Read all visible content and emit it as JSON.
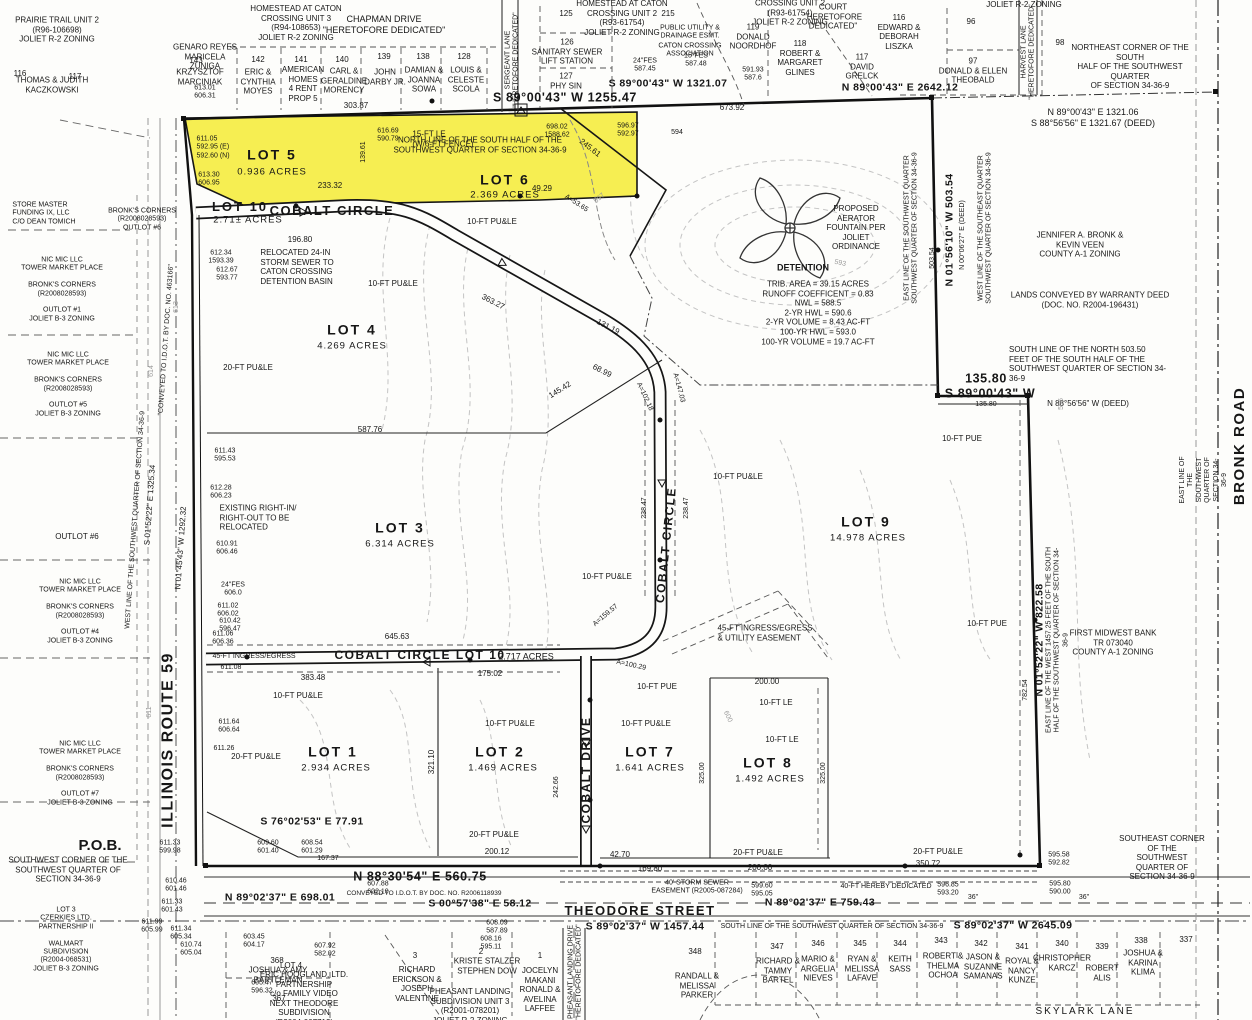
{
  "colors": {
    "highlight": "#f6ee52",
    "ink": "#161616",
    "contour": "#9a9a9a",
    "paper": "#fdfdfb"
  },
  "L": {
    "prairie": "PRAIRIE TRAIL UNIT 2\n(R96-106698)\nJOLIET R-2 ZONING",
    "genaro": "GENARO REYES\nMARICELA\nZUNIGA",
    "n116a": "116",
    "kaczkowski": "THOMAS & JUDITH\nKACZKOWSKI",
    "n117a": "117",
    "n143": "143",
    "marciniak": "KRZYSZTOF\nMARCINIAK",
    "el1": "613.01\n606.31",
    "n142": "142",
    "moyes": "ERIC &\nCYNTHIA\nMOYES",
    "n141": "141",
    "american": "AMERICAN\nHOMES\n4 RENT\nPROP 5",
    "n140": "140",
    "morency": "CARL &\nGERALDINE\nMORENCY",
    "n139": "139",
    "darby": "JOHN\nDARBY JR.",
    "n138": "138",
    "sowa": "DAMIAN &\nJOANNA\nSOWA",
    "n128": "128",
    "scola": "LOUIS &\nCELESTE\nSCOLA",
    "homestead3": "HOMESTEAD AT CATON\nCROSSING UNIT 3\n(R94-108653)\nJOLIET R-2 ZONING",
    "chapman": "CHAPMAN DRIVE\n\"HERETOFORE DEDICATED\"",
    "sergeant": "SERGEANT LANE\n\"HERETOFORE DEDICATED\"",
    "n125": "125",
    "sanitary": "126\nSANITARY SEWER\nLIFT STATION",
    "physin": "127\nPHY SIN",
    "homestead2": "HOMESTEAD AT CATON\nCROSSING UNIT 2\n(R93-61754)\nJOLIET R-2 ZONING",
    "n215": "215",
    "pude": "PUBLIC UTILITY &\nDRAINAGE ESMT.",
    "caton": "CATON CROSSING\nASSOCIATION",
    "fes587a": "24\"FES\n587.45",
    "fes587b": "15\"FES\n587.48",
    "dim1321": "S 89°00'43\" W 1321.07",
    "dim1255": "S 89°00'43\" W 1255.47",
    "homestead2b": "CROSSING UNIT 2\n(R93-61754)\nJOLIET R-2 ZONING",
    "court": "COURT\n\"HERETOFORE\nDEDICATED\"",
    "noordhof": "119\nDONALD\nNOORDHOF",
    "glines": "118\nROBERT &\nMARGARET\nGLINES",
    "el2": "591.93\n587.6",
    "liszka": "116\nEDWARD &\nDEBORAH\nLISZKA",
    "grelck": "117\nDAVID\nGRELCK",
    "n96": "96",
    "theobald": "97\nDONALD & ELLEN\nTHEOBALD",
    "harvest": "HARVEST LANE\n\"HERETOFORE DEDICATED\"",
    "n98": "98",
    "jolietr2": "JOLIET R-2 ZONING",
    "necorner": "NORTHEAST CORNER OF THE SOUTH\nHALF OF THE SOUTHWEST QUARTER\nOF SECTION 34-36-9",
    "dim2642": "N 89°00'43\" E 2642.12",
    "dim1321b": "N 89°00'43\" E 1321.06\nS 88°56'56\" E 1321.67 (DEED)",
    "d673": "673.92",
    "el3": "698.02\n1588.62",
    "el4": "616.69\n590.79",
    "northline": "NORTH LINE OF THE SOUTH HALF OF THE\nSOUTHWEST QUARTER OF SECTION 34-36-9",
    "d245": "245.61",
    "lot5": "LOT 5",
    "lot5a": "0.936 ACRES",
    "el5": "611.05\n592.95 (E)\n592.60 (N)",
    "el6": "613.30\n606.95",
    "le15": "15-FT LE\n(W/6-FT FENCE)",
    "d303": "303.87",
    "d233": "233.32",
    "d49": "49.29",
    "a53": "A=53.65",
    "lot10": "LOT 10",
    "lot10a": "2.71± ACRES",
    "cobaltcircle": "COBALT CIRCLE",
    "lot6": "LOT 6",
    "lot6a": "2.369 ACRES",
    "el7": "596.97\n592.97",
    "c594a": "594",
    "d139": "139.61",
    "aerator": "PROPOSED\nAERATOR\nFOUNTAIN PER\nJOLIET\nORDINANCE",
    "detention": "DETENTION",
    "detdata": "TRIB. AREA = 39.15 ACRES\nRUNOFF COEFFICENT = 0.83\nNWL = 588.5\n2-YR HWL = 590.6\n2-YR VOLUME = 8.43 AC-FT\n100-YR HWL = 593.0\n100-YR VOLUME = 19.7 AC-FT",
    "eastline1": "EAST LINE OF THE SOUTHWEST QUARTER\nSOUTHWEST QUARTER OF SECTION 34-36-9",
    "dim503": "N 01°56'10\" W 503.54",
    "dim503d": "N 00°06'27\" E (DEED)",
    "d503": "503.54",
    "westline1": "WEST LINE OF THE SOUTHEAST QUARTER\nSOUTHWEST QUARTER OF SECTION 34-36-9",
    "bronkveen": "JENNIFER A. BRONK &\nKEVIN VEEN\nCOUNTY A-1 ZONING",
    "lands": "LANDS CONVEYED BY WARRANTY DEED\n(DOC. NO. R2004-196431)",
    "southline503": "SOUTH LINE OF THE NORTH 503.50\nFEET OF THE SOUTH HALF OF THE\nSOUTHWEST QUARTER OF SECTION 34-36-9",
    "d135": "135.80",
    "dim8900": "S 89°00'43\" W",
    "d135b": "135.80",
    "dim8856": "N 88°56'56\" W (DEED)",
    "pue1": "10-FT PUE",
    "eastline2": "EAST LINE OF THE SOUTHWEST QUARTER OF SECTION 34-36-9",
    "bronkroad": "BRONK ROAD",
    "lot4": "LOT 4",
    "lot4a": "4.269 ACRES",
    "pu20a": "20-FT PU&LE",
    "relocated": "RELOCATED 24-IN\nSTORM SEWER TO\nCATON CROSSING\nDETENTION BASIN",
    "el8": "612.34\n1593.39",
    "el9": "612.67\n593.77",
    "pu10a": "10-FT PU&LE",
    "pu10b": "10-FT PU&LE",
    "d196": "196.80",
    "d587": "587.76",
    "el10": "611.43\n595.53",
    "el11": "612.28\n606.23",
    "existing": "EXISTING RIGHT-IN/\nRIGHT-OUT TO BE\nRELOCATED",
    "el12": "610.91\n606.46",
    "fes606": "24\"FES\n606.0",
    "el13": "611.02\n606.02",
    "el14": "610.42\n596.47",
    "el15": "611.06\n606.36",
    "d45a": "45-FT INGRESS/EGRESS",
    "el16": "611.08",
    "lot3": "LOT 3",
    "lot3a": "6.314 ACRES",
    "cclot10": "COBALT CIRCLE LOT 10",
    "lot10b": "2.717 ACRES",
    "d645": "645.63",
    "d383": "383.48",
    "d175": "175.02",
    "pu10c": "10-FT PU&LE",
    "lot1": "LOT 1",
    "lot1a": "2.934 ACRES",
    "lot2": "LOT 2",
    "lot2a": "1.469 ACRES",
    "d321": "321.10",
    "pu10d": "10-FT PU&LE",
    "d242": "242.66",
    "cobaltdrive": "COBALT DRIVE",
    "s76": "S 76°02'53\" E 77.91",
    "pu20b": "20-FT PU&LE",
    "d200a": "200.12",
    "lot7": "LOT 7",
    "lot7a": "1.641 ACRES",
    "lot8": "LOT 8",
    "lot8a": "1.492 ACRES",
    "ease45": "45-FT INGRESS/EGRESS\n& UTILITY EASEMENT",
    "pue2": "10-FT PUE",
    "le10a": "10-FT LE",
    "le10b": "10-FT LE",
    "d200b": "200.00",
    "d325a": "325.00",
    "d325b": "325.00",
    "pu10e": "10-FT PU&LE",
    "lot9": "LOT 9",
    "lot9a": "14.978 ACRES",
    "ccvert": "COBALT CIRCLE",
    "d238a": "238.47",
    "d238b": "238.47",
    "pu10f": "10-FT PU&LE",
    "pu10g": "10-FT PU&LE",
    "d131": "131.19",
    "d363": "363.27",
    "d145": "145.42",
    "d68": "68.99",
    "a102": "A=102.18",
    "a147": "A=147.03",
    "a159": "A=159.57",
    "a100": "A=100.29",
    "dim822": "N 01°52'22\" W 822.58",
    "d782": "782.54",
    "pue3": "10-FT PUE",
    "east1457": "EAST LINE OF THE WEST 1457.25 FEET OF THE SOUTH\nHALF OF THE SOUTHWEST QUARTER OF SECTION 34-36-9",
    "midwest": "FIRST MIDWEST BANK\nTR 073040\nCOUNTY A-1 ZONING",
    "pob": "P.O.B.",
    "swcorner": "SOUTHWEST CORNER OF THE\nSOUTHWEST QUARTER OF\nSECTION 34-36-9",
    "el17": "611.33\n599.98",
    "el18": "610.46\n601.46",
    "el19": "611.33\n601.43",
    "el20": "611.99\n605.99",
    "el21": "611.34\n605.34",
    "el22": "610.74\n605.04",
    "el609": "609.60\n601.40",
    "el608a": "608.54\n601.29",
    "d167": "167.37",
    "dim560": "N 88°30'54\" E 560.75",
    "dim698": "N 89°02'37\" E 698.01",
    "conv": "CONVEYED TO I.D.O.T. BY DOC. NO. R2006118939",
    "el607": "607.88\n602.10",
    "dim58": "S 00°57'38\" E 58.12",
    "theodore": "THEODORE STREET",
    "dim759": "N 89°02'37\" E 759.43",
    "dim1457": "S 89°02'37\" W 1457.44",
    "southline": "SOUTH LINE OF THE SOUTHWEST QUARTER OF SECTION 34-36-9",
    "dim2645": "S 89°02'37\" W 2645.09",
    "storm": "40' STORM SEWER\nEASEMENT (R2005-087284)",
    "el599": "599.60\n595.05",
    "ded40": "40-FT HEREBY DEDICATED",
    "el596b": "596.85\n593.20",
    "d42": "42.70",
    "d169": "169.80",
    "d200c": "200.00",
    "pu20c": "20-FT PU&LE",
    "pu20d": "20-FT PU&LE",
    "d350": "350.72",
    "el595a": "595.58\n592.82",
    "el595b": "595.80\n590.00",
    "d36a": "36\"",
    "d36b": "36\"",
    "secorner": "SOUTHEAST CORNER OF THE\nSOUTHWEST QUARTER OF\nSECTION 34-36-9",
    "n368": "368",
    "bartleman": "JOSHUA & AMY\nBARTLEMAN",
    "el605": "605.47\n596.32",
    "n367": "367",
    "lot4b": "LOT 4",
    "hoogland": "ERIC HOOGLAND, LTD.\nPARTNERSHIP\nc/o FAMILY VIDEO\nNEXT THEODORE\nSUBDIVISION\n(R2004-007713)",
    "el607b": "607.92\n582.02",
    "el603": "603.45\n604.17",
    "pheasantdr": "PHEASANT LANDING DRIVE\n\"HERETOFORE DEDICATED\"",
    "n3": "3",
    "erickson": "RICHARD\nERICKSON &\nJOSEPH\nVALENTINE",
    "n2": "2",
    "stalzer": "KRISTE STALZER\nSTEPHEN DOW",
    "el608b": "608.16\n595.11",
    "n1": "1",
    "makani": "JOCELYN\nMAKANI\nRONALD &\nAVELINA\nLAFFEE",
    "pheasant3": "PHEASANT LANDING\nSUBDIVISION UNIT 3\n(R2001-078201)\nJOLIET R-2 ZONING",
    "el608c": "608.09\n587.89",
    "n348": "348",
    "parker": "RANDALL &\nMELISSA\nPARKER",
    "n347": "347",
    "bartel": "RICHARD &\nTAMMY\nBARTEL",
    "n346": "346",
    "nieves": "MARIO &\nARGELIA\nNIEVES",
    "n345": "345",
    "lafave": "RYAN &\nMELISSA\nLAFAVE",
    "n344": "344",
    "sass": "KEITH\nSASS",
    "n343": "343",
    "ochoa": "ROBERT &\nTHELMA\nOCHOA",
    "n342": "342",
    "samanas": "JASON &\nSUZANNE\nSAMANAS",
    "n341": "341",
    "kunze": "ROYAL &\nNANCY\nKUNZE",
    "n340": "340",
    "karcz": "CHRISTOPHER\nKARCZ",
    "n339": "339",
    "alis": "ROBERT\nALIS",
    "n338": "338",
    "klima": "JOSHUA &\nKARINA\nKLIMA",
    "n337": "337",
    "skylark": "SKYLARK LANE",
    "store": "STORE MASTER\nFUNDING IX, LLC\nC/O DEAN TOMICH",
    "bronks6": "BRONK'S CORNERS\n(R2008028593)\nOUTLOT #6",
    "outlot1": "NIC MIC LLC\nTOWER MARKET PLACE\n\nBRONK'S CORNERS\n(R2008028593)\n\nOUTLOT #1\nJOLIET B-3 ZONING",
    "outlot5": "NIC MIC LLC\nTOWER MARKET PLACE\n\nBRONK'S CORNERS\n(R2008028593)\n\nOUTLOT #5\nJOLIET B-3 ZONING",
    "outlot6": "OUTLOT #6",
    "outlot4": "NIC MIC LLC\nTOWER MARKET PLACE\n\nBRONK'S CORNERS\n(R2008028593)\n\nOUTLOT #4\nJOLIET B-3 ZONING",
    "outlot7": "NIC MIC LLC\nTOWER MARKET PLACE\n\nBRONK'S CORNERS\n(R2008028593)\n\nOUTLOT #7\nJOLIET B-3 ZONING",
    "czerkies": "LOT 3\nCZERKIES LTD.\nPARTNERSHIP II\n\nWALMART\nSUBDIVISION\n(R2004-068531)\nJOLIET B-3 ZONING",
    "il59": "ILLINOIS ROUTE 59",
    "westline2": "WEST LINE OF THE SOUTHWEST QUARTER OF SECTION 34-36-9",
    "dim1325": "S 01°52'22\" E 1325.34",
    "dim1292": "N 01°45'43\" W 1292.32",
    "conveyed": "\"CONVEYED TO I.D.O.T. BY DOC. NO. 463166\"",
    "el25": "611.64\n606.64",
    "el26": "611.26",
    "pu20e": "20-FT PU&LE",
    "c614": "614",
    "c613": "613",
    "c611": "611",
    "c600": "600",
    "c596": "596",
    "c593": "593",
    "c597": "597"
  }
}
